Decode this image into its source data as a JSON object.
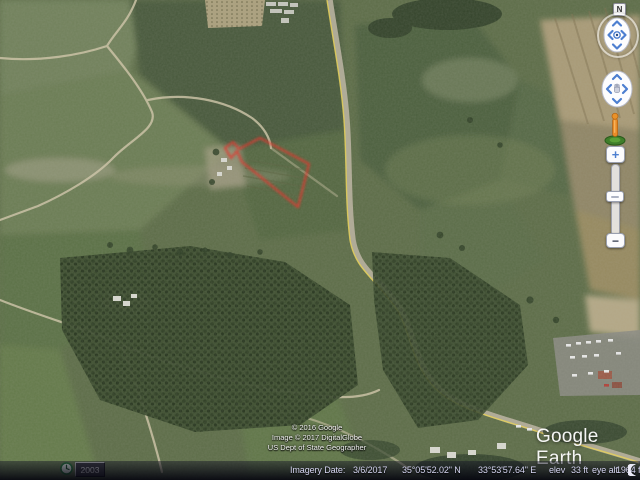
{
  "app": {
    "title": "Google Earth"
  },
  "logo": {
    "text": "Google Earth"
  },
  "attribution": {
    "lines": [
      "© 2016 Google",
      "Image © 2017 DigitalGlobe",
      "US Dept of State Geographer"
    ]
  },
  "historical_imagery": {
    "year": "2003",
    "icon": "clock-icon"
  },
  "status_bar": {
    "imagery_date_label": "Imagery Date:",
    "imagery_date_value": "3/6/2017",
    "latitude": "35°05'52.02\" N",
    "longitude": "33°53'57.64\" E",
    "elevation_label": "elev",
    "elevation_value": "33 ft",
    "eye_altitude_label": "eye alt",
    "eye_altitude_value": "1964 ft",
    "spinner_icon": "crescent-moon-icon"
  },
  "navigation": {
    "north_label": "N",
    "zoom_in_label": "+",
    "zoom_out_label": "−",
    "controls": [
      "look-joystick",
      "move-joystick",
      "street-view-pegman",
      "zoom-slider"
    ]
  },
  "map": {
    "type": "satellite-imagery",
    "overlay_polygon": {
      "label": "highlighted-parcel",
      "stroke_color": "#e03127"
    },
    "colors": {
      "field_green": "#5c6c47",
      "road": "#b6b09c",
      "road_stripe": "#e5cf55",
      "dirt_path": "#d0c6a8",
      "trees": "#35462b",
      "status_text": "#d6d6f2"
    }
  }
}
